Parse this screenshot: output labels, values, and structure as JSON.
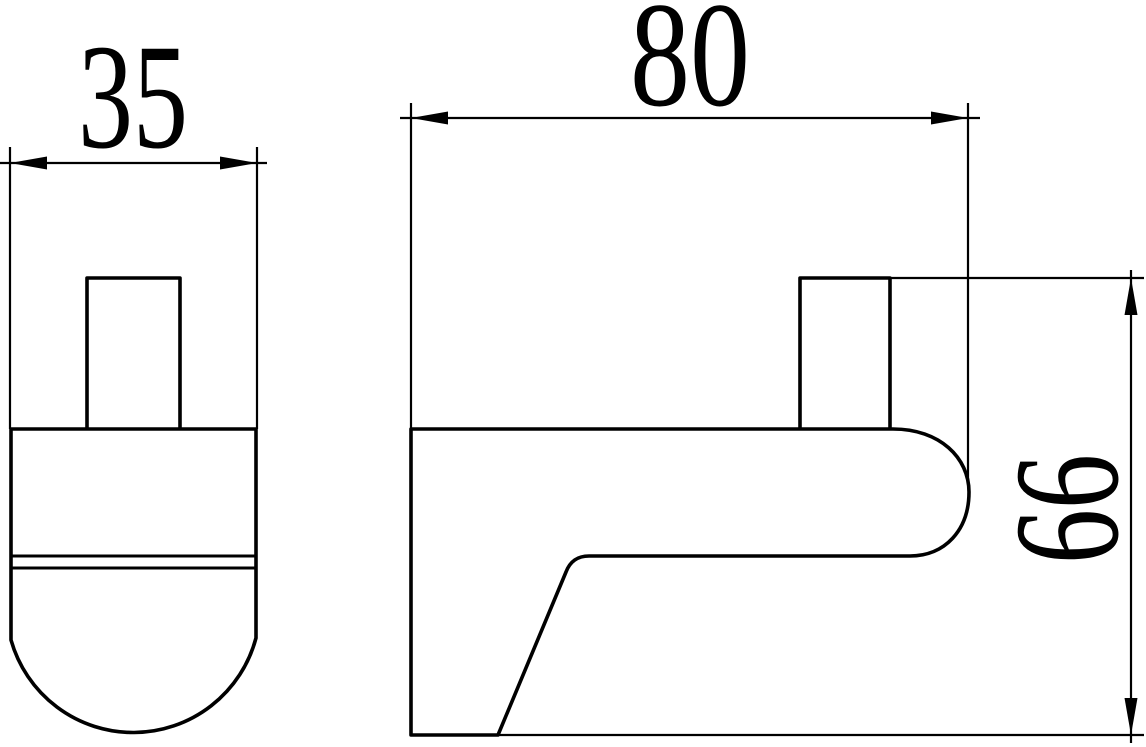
{
  "drawing": {
    "description": "orthographic technical drawing of a shelf bracket hook, two views",
    "background_color": "#ffffff",
    "line_color": "#000000",
    "dimension_labels": {
      "front_width": "35",
      "side_depth": "80",
      "side_height": "66"
    }
  }
}
